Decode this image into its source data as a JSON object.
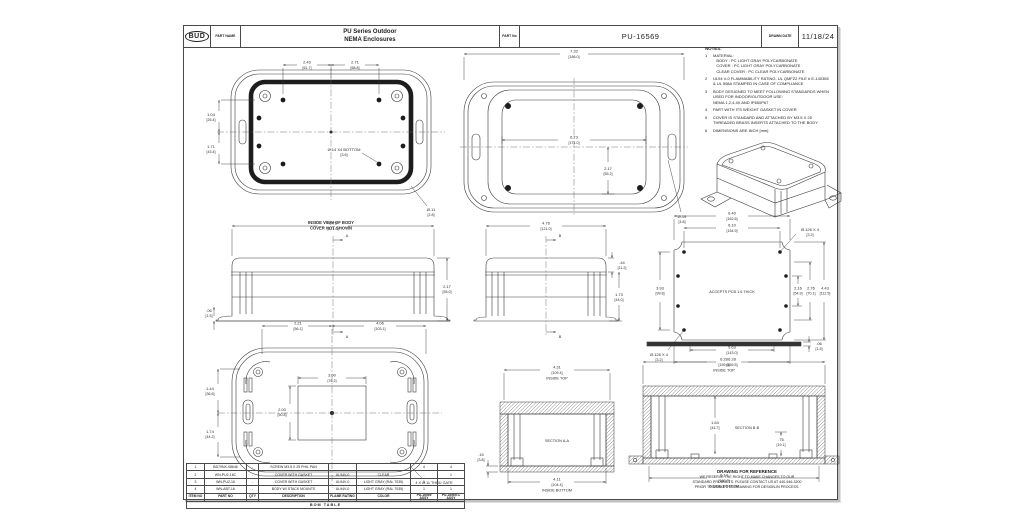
{
  "header": {
    "logo": "BUD",
    "part_name_label": "PART NAME",
    "title": "PU Series Outdoor\nNEMA Enclosures",
    "part_no_label": "PART No",
    "part_no": "PU-16569",
    "date_label": "DRAWN DATE",
    "date": "11/18/24"
  },
  "notes": {
    "title": "NOTES:",
    "items": [
      {
        "num": "1",
        "text": "MATERIAL:\n   BODY : PC LIGHT GRAY POLYCARBONATE\n   COVER : PC LIGHT GRAY POLYCARBONATE\n   CLEAR COVER : PC CLEAR POLYCARBONATE"
      },
      {
        "num": "2",
        "text": "UL94 V-0 FLAMMABILITY RATING. UL QMFZ2 FILE # E-140355\n& UL 508A STAMPED IN CASE OF COMPLIANCE"
      },
      {
        "num": "3",
        "text": "BODY DESIGNED TO MEET FOLLOWING STANDARDS WHEN\nUSED FOR INDOOR/OUTDOOR USE:\nNEMA 1,2,4,4X AND IP65/IP67"
      },
      {
        "num": "4",
        "text": "PART WITH ITS WEIGHT GASKET IN COVER"
      },
      {
        "num": "5",
        "text": "COVER IS STANDARD AND ATTACHED BY M3.5 X 25\nTHREADED BRASS INSERTS ATTACHED TO THE BODY"
      },
      {
        "num": "6",
        "text": "DIMENSIONS ARE INCH [mm]"
      }
    ]
  },
  "views": {
    "inside_body": {
      "caption1": "INSIDE VIEW OF BODY",
      "caption2": "COVER NOT SHOWN",
      "dim_top_left": {
        "in": "2.43",
        "mm": "[61.7]"
      },
      "dim_top_right": {
        "in": "2.71",
        "mm": "[68.8]"
      },
      "dim_left_upper": {
        "in": "1.04",
        "mm": "[26.4]"
      },
      "dim_left_lower": {
        "in": "1.71",
        "mm": "[43.4]"
      },
      "callout_boss": {
        "in": "Ø.14 X4 BOTTOM",
        "mm": "[3.6]"
      },
      "callout_corner": {
        "in": "Ø.11",
        "mm": "[2.8]"
      }
    },
    "outside_top": {
      "dim_overall": {
        "in": "7.32",
        "mm": "[186.0]"
      },
      "dim_body": {
        "in": "6.73",
        "mm": "[171.0]"
      },
      "dim_half": {
        "in": "2.17",
        "mm": "[55.2]"
      },
      "callout_hole": {
        "in": "Ø.19",
        "mm": "[4.8]"
      }
    },
    "front_elev": {
      "dim_width": {
        "in": "6.73",
        "mm": "[171.0]"
      },
      "dim_height": {
        "in": "2.17",
        "mm": "[55.0]"
      },
      "dim_flange": {
        "in": ".06",
        "mm": "[1.5]"
      },
      "section_letter": "A"
    },
    "end_elev": {
      "dim_width": {
        "in": "4.76",
        "mm": "[121.0]"
      },
      "dim_height": {
        "in": "1.73",
        "mm": "[44.0]"
      },
      "dim_cover": {
        "in": ".44",
        "mm": "[11.2]"
      },
      "section_letter": "B"
    },
    "pcb_pattern": {
      "center_text": "ACCEPTS PCB 1.6 THICK",
      "dim_top_outer": {
        "in": "6.40",
        "mm": "[162.6]"
      },
      "dim_top_inner": {
        "in": "6.10",
        "mm": "[154.9]"
      },
      "dim_bot_inner": {
        "in": "5.63",
        "mm": "[143.0]"
      },
      "dim_bot_outer": {
        "in": "6.28",
        "mm": "[159.5]"
      },
      "dim_right_1": {
        "in": "2.16",
        "mm": "[54.9]"
      },
      "dim_right_2": {
        "in": "2.76",
        "mm": "[70.1]"
      },
      "dim_right_3": {
        "in": "4.43",
        "mm": "[112.5]"
      },
      "dim_left": {
        "in": "3.93",
        "mm": "[99.8]"
      },
      "callout_top": {
        "in": "Ø.126 X 4",
        "mm": "[3.2]"
      },
      "callout_bot": {
        "in": "Ø.126 X 4",
        "mm": "[3.2]"
      }
    },
    "bottom_view": {
      "dim_top_left": {
        "in": "2.21",
        "mm": "[56.1]"
      },
      "dim_top_right": {
        "in": "4.06",
        "mm": "[103.1]"
      },
      "dim_recess_w": {
        "in": "3.00",
        "mm": "[76.2]"
      },
      "dim_recess_h": {
        "in": "2.00",
        "mm": "[50.8]"
      },
      "dim_left_upper": {
        "in": "1.44",
        "mm": "[36.6]"
      },
      "dim_left_lower": {
        "in": "1.74",
        "mm": "[44.2]"
      },
      "callout_gate": "4 X Ø.11 THRU GATE"
    },
    "section_aa": {
      "label": "SECTION A-A",
      "dim_top": {
        "in": "4.31",
        "mm": "[109.4]"
      },
      "dim_top_caption": "INSIDE TOP",
      "dim_bottom": {
        "in": "4.11",
        "mm": "[104.4]"
      },
      "dim_bottom_caption": "INSIDE BOTTOM",
      "dim_left": {
        "in": ".15",
        "mm": "[3.8]"
      }
    },
    "section_bb": {
      "label": "SECTION B-B",
      "dim_panel": {
        "in": ".06",
        "mm": "[1.5]"
      },
      "dim_top": {
        "in": "6.28",
        "mm": "[159.6]"
      },
      "dim_top_caption": "INSIDE TOP",
      "dim_bottom": {
        "in": "6.14",
        "mm": "[156.0]"
      },
      "dim_bottom_caption": "INSIDE BOTTOM",
      "dim_inner_h": {
        "in": "1.64",
        "mm": "[41.7]"
      },
      "dim_boss": {
        "in": ".75",
        "mm": "[19.1]"
      }
    }
  },
  "bom": {
    "title": "BOM TABLE",
    "headers": [
      "ITEM NO",
      "PART NO",
      "QTY",
      "DESCRIPTION",
      "FLAME RATING",
      "COLOR",
      "PU-16569 ASSY",
      "PU-16569-C ASSY"
    ],
    "rows": [
      [
        "1",
        "BD79NX-08646",
        "-",
        "SCREW M3.5 X 25 PHIL PAN",
        "",
        "",
        "4",
        "4"
      ],
      [
        "2",
        "WN-PU2-16C",
        "-",
        "COVER WITH GASKET",
        "UL94V-0",
        "CLEAR",
        "-",
        "1"
      ],
      [
        "3",
        "WN-PU2-16",
        "-",
        "COVER WITH GASKET",
        "UL94V-0",
        "LIGHT GRAY (RAL 7035)",
        "1",
        "-"
      ],
      [
        "4",
        "WN-ABT-16",
        "-",
        "BODY W/ STACK MOUNTS",
        "UL94V-0",
        "LIGHT GRAY (RAL 7035)",
        "1",
        "1"
      ]
    ]
  },
  "reference": {
    "line1": "DRAWING FOR REFERENCE",
    "line2": "WE RESERVE THE RIGHT TO MAKE CHANGES TO OUR",
    "line3": "STANDARD PRODUCTS. PLEASE CONTACT US AT 440-946-3200",
    "line4": "PRIOR TO USING THIS DRAWING FOR DESIGN-IN PROCESS."
  }
}
